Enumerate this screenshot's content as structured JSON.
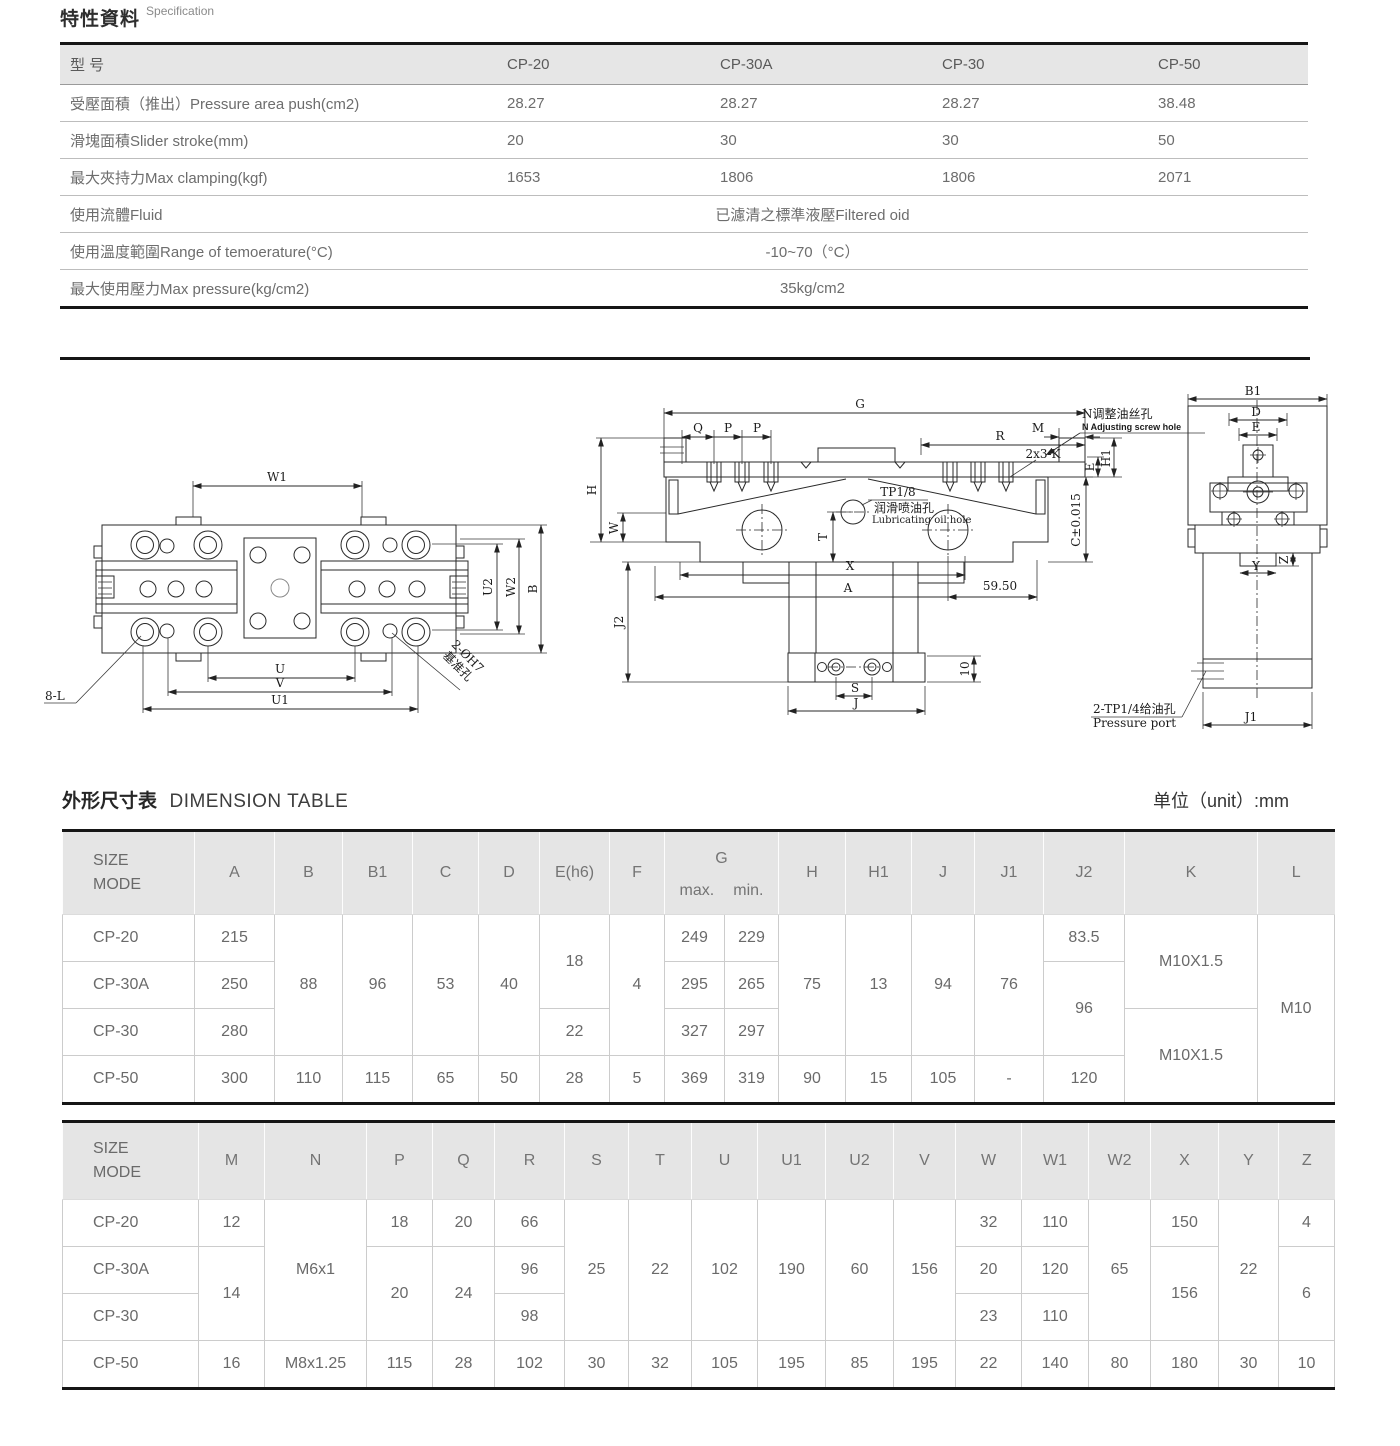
{
  "spec_section": {
    "title_zh": "特性資料",
    "title_en": "Specification",
    "table": {
      "headers": [
        "型  号",
        "CP-20",
        "CP-30A",
        "CP-30",
        "CP-50"
      ],
      "rows": [
        {
          "label": "受壓面積（推出）Pressure area push(cm2)",
          "values": [
            "28.27",
            "28.27",
            "28.27",
            "38.48"
          ]
        },
        {
          "label": "滑塊面積Slider stroke(mm)",
          "values": [
            "20",
            "30",
            "30",
            "50"
          ]
        },
        {
          "label": "最大夾持力Max clamping(kgf)",
          "values": [
            "1653",
            "1806",
            "1806",
            "2071"
          ]
        },
        {
          "label": "使用流體Fluid",
          "span": "已濾清之標準液壓Filtered oid"
        },
        {
          "label": "使用溫度範圍Range of temoerature(°C)",
          "span": "-10~70（°C）"
        },
        {
          "label": "最大使用壓力Max pressure(kg/cm2)",
          "span": "35kg/cm2"
        }
      ]
    }
  },
  "dimension_section": {
    "title_zh": "外形尺寸表",
    "title_en": "DIMENSION TABLE",
    "unit": "单位（unit）:mm",
    "table1": {
      "headers": {
        "size": "SIZE",
        "mode": "MODE",
        "a": "A",
        "b": "B",
        "b1": "B1",
        "c": "C",
        "d": "D",
        "e": "E(h6)",
        "f": "F",
        "g": "G",
        "gmax": "max.",
        "gmin": "min.",
        "h": "H",
        "h1": "H1",
        "j": "J",
        "j1": "J1",
        "j2": "J2",
        "k": "K",
        "l": "L"
      },
      "rows": [
        {
          "name": "CP-20",
          "a": "215",
          "b": "88",
          "b1": "96",
          "c": "53",
          "d": "40",
          "e": "18",
          "f": "4",
          "gmax": "249",
          "gmin": "229",
          "h": "75",
          "h1": "13",
          "j": "94",
          "j1": "76",
          "j2": "83.5",
          "k": "M10X1.5",
          "l": "M10"
        },
        {
          "name": "CP-30A",
          "a": "250",
          "gmax": "295",
          "gmin": "265",
          "j2": "96"
        },
        {
          "name": "CP-30",
          "a": "280",
          "e": "22",
          "gmax": "327",
          "gmin": "297",
          "k": "M10X1.5"
        },
        {
          "name": "CP-50",
          "a": "300",
          "b": "110",
          "b1": "115",
          "c": "65",
          "d": "50",
          "e": "28",
          "f": "5",
          "gmax": "369",
          "gmin": "319",
          "h": "90",
          "h1": "15",
          "j": "105",
          "j1": "-",
          "j2": "120"
        }
      ]
    },
    "table2": {
      "headers": {
        "size": "SIZE",
        "mode": "MODE",
        "m": "M",
        "n": "N",
        "p": "P",
        "q": "Q",
        "r": "R",
        "s": "S",
        "t": "T",
        "u": "U",
        "u1": "U1",
        "u2": "U2",
        "v": "V",
        "w": "W",
        "w1": "W1",
        "w2": "W2",
        "x": "X",
        "y": "Y",
        "z": "Z"
      },
      "rows": [
        {
          "name": "CP-20",
          "m": "12",
          "n": "M6x1",
          "p": "18",
          "q": "20",
          "r": "66",
          "s": "25",
          "t": "22",
          "u": "102",
          "u1": "190",
          "u2": "60",
          "v": "156",
          "w": "32",
          "w1": "110",
          "w2": "65",
          "x": "150",
          "y": "22",
          "z": "4"
        },
        {
          "name": "CP-30A",
          "m": "14",
          "p": "20",
          "q": "24",
          "r": "96",
          "w": "20",
          "w1": "120",
          "x": "156",
          "z": "6"
        },
        {
          "name": "CP-30",
          "r": "98",
          "w": "23",
          "w1": "110"
        },
        {
          "name": "CP-50",
          "m": "16",
          "n": "M8x1.25",
          "p": "115",
          "q": "28",
          "r": "102",
          "s": "30",
          "t": "32",
          "u": "105",
          "u1": "195",
          "u2": "85",
          "v": "195",
          "w": "22",
          "w1": "140",
          "w2": "80",
          "x": "180",
          "y": "30",
          "z": "10"
        }
      ]
    }
  },
  "drawings": {
    "top_view": {
      "w1": "W1",
      "u": "U",
      "v": "V",
      "u1": "U1",
      "u2": "U2",
      "w2": "W2",
      "b": "B",
      "holes": "8-L",
      "datum1": "2-ØH7",
      "datum2": "基准孔"
    },
    "front_view": {
      "g": "G",
      "q": "Q",
      "p1": "P",
      "p2": "P",
      "m": "M",
      "r": "R",
      "k": "2x3-K",
      "h": "H",
      "w": "W",
      "t": "T",
      "e": "E",
      "h1": "H1",
      "c": "C±0.015",
      "x": "X",
      "a": "A",
      "d5950": "59.50",
      "j2": "J2",
      "d10": "10",
      "s": "S",
      "j": "J",
      "tp": "TP1/8",
      "lub_zh": "润滑喷油孔",
      "lub_en": "Lubricating oil hole",
      "adj_zh": "N调整油丝孔",
      "adj_en": "N Adjusting screw hole"
    },
    "side_view": {
      "b1": "B1",
      "d": "D",
      "e": "E",
      "z": "Z",
      "y": "Y",
      "j1": "J1",
      "port_zh": "2-TP1/4给油孔",
      "port_en": "Pressure port"
    }
  }
}
